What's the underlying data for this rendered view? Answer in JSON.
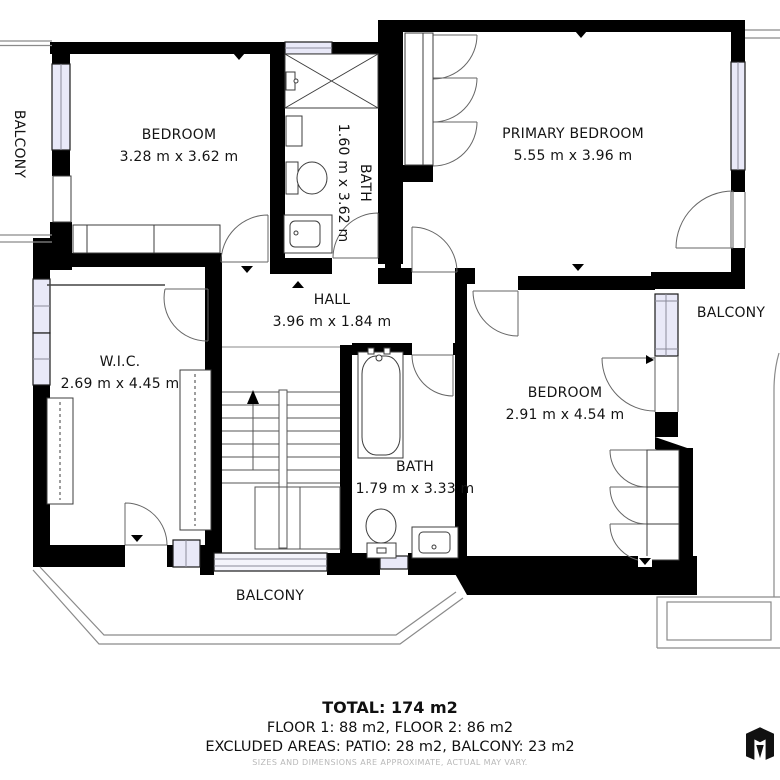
{
  "floorplan": {
    "rooms": {
      "bedroom_top_left": {
        "name": "BEDROOM",
        "dims": "3.28 m x 3.62 m"
      },
      "bath_top": {
        "name": "BATH",
        "dims": "1.60 m x 3.62 m"
      },
      "primary_bedroom": {
        "name": "PRIMARY BEDROOM",
        "dims": "5.55 m x 3.96 m"
      },
      "hall": {
        "name": "HALL",
        "dims": "3.96 m x 1.84 m"
      },
      "wic": {
        "name": "W.I.C.",
        "dims": "2.69 m x 4.45 m"
      },
      "bedroom_right": {
        "name": "BEDROOM",
        "dims": "2.91 m x 4.54 m"
      },
      "bath_bottom": {
        "name": "BATH",
        "dims": "1.79 m x 3.33 m"
      }
    },
    "balconies": {
      "left": "BALCONY",
      "right": "BALCONY",
      "bottom": "BALCONY"
    },
    "summary": {
      "total": "TOTAL: 174 m2",
      "floors": "FLOOR 1: 88 m2, FLOOR 2: 86 m2",
      "excluded": "EXCLUDED AREAS: PATIO: 28 m2, BALCONY: 23 m2",
      "disclaimer": "SIZES AND DIMENSIONS ARE APPROXIMATE, ACTUAL MAY VARY."
    },
    "colors": {
      "wall": "#000000",
      "window": "#e9e9f8",
      "line": "#666666",
      "label": "#141414",
      "muted": "#b9b9b9"
    }
  }
}
